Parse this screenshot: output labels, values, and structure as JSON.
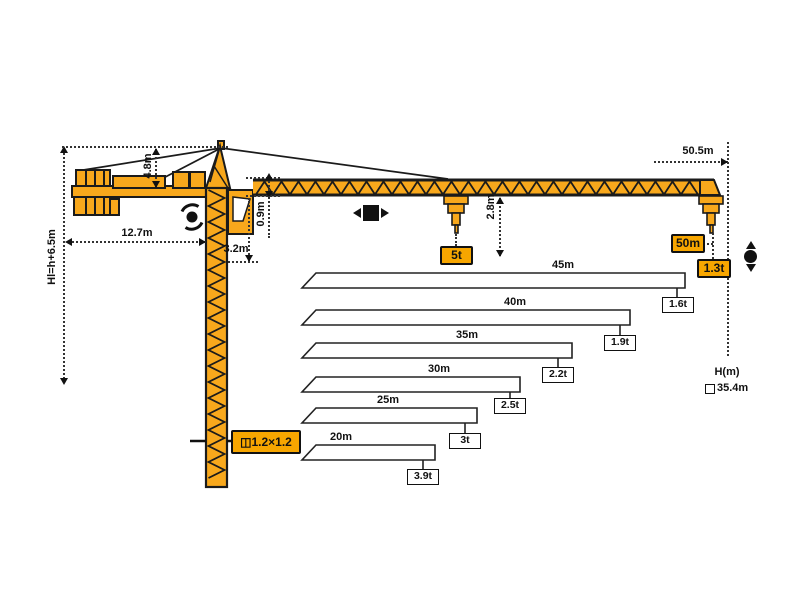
{
  "colors": {
    "crane": "#F8A81C",
    "tag_background": "#F7A600",
    "line": "#1A1A1A"
  },
  "dimensions": {
    "height_formula": "Hl=h+6.5m",
    "apex_height": "4.8m",
    "counterjib_length": "12.7m",
    "tower_head_height": "3.2m",
    "jib_depth": "0.9m",
    "hook_headroom": "2.8m",
    "max_radius": "50.5m"
  },
  "tags": {
    "max_capacity": "5t",
    "tip_radius": "50m",
    "tip_capacity": "1.3t",
    "mast_section": "1.2×1.2",
    "mast_section_icon": "◫"
  },
  "height_panel": {
    "label": "H(m)",
    "value": "35.4m"
  },
  "icons": {
    "slewing": "rotation-arrows",
    "trolley_travel": "left-right-arrows-with-square",
    "hoist": "up-down-arrows-with-dot"
  },
  "chart_data": {
    "type": "bar",
    "orientation": "horizontal",
    "categories": [
      "45m",
      "40m",
      "35m",
      "30m",
      "25m",
      "20m"
    ],
    "values": [
      1.6,
      1.9,
      2.2,
      2.5,
      3,
      3.9
    ],
    "unit": "t",
    "bars": [
      {
        "length": "45m",
        "capacity": "1.6t"
      },
      {
        "length": "40m",
        "capacity": "1.9t"
      },
      {
        "length": "35m",
        "capacity": "2.2t"
      },
      {
        "length": "30m",
        "capacity": "2.5t"
      },
      {
        "length": "25m",
        "capacity": "3t"
      },
      {
        "length": "20m",
        "capacity": "3.9t"
      }
    ],
    "jib_tip": {
      "radius": "50m",
      "capacity": "1.3t"
    },
    "max_capacity": "5t"
  }
}
